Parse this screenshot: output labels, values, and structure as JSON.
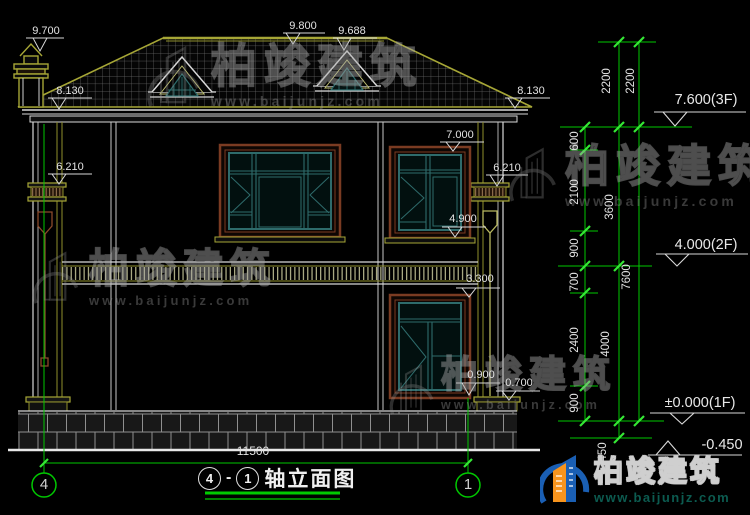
{
  "drawing": {
    "title": {
      "axis_left": "4",
      "dash": "-",
      "axis_right": "1",
      "name": "轴立面图"
    },
    "total_width_dim": "11500",
    "axis_bubbles": {
      "left": "4",
      "right": "1"
    },
    "elevations": {
      "chimney_top": "9.700",
      "ridge": "9.800",
      "dormer_top": "9.688",
      "eave_left": "8.130",
      "eave_right": "8.130",
      "capital_left": "6.210",
      "capital_right": "6.210",
      "win2f_head": "7.000",
      "win2f_sill": "4.900",
      "win1f_head": "3.300",
      "win1f_sill": "0.900",
      "pedestal_top": "0.700"
    },
    "levels": {
      "f3": "7.600(3F)",
      "f2": "4.000(2F)",
      "f1": "±0.000(1F)",
      "ground": "-0.450"
    },
    "dims": {
      "detail": [
        "600",
        "2100",
        "900",
        "700",
        "2400",
        "900"
      ],
      "floors": [
        "2200",
        "3600",
        "4000",
        "450"
      ],
      "totals": [
        "2200",
        "7600"
      ]
    }
  },
  "watermark": {
    "brand": "柏竣建筑",
    "url": "www.baijunjz.com"
  },
  "logo": {
    "brand": "柏竣建筑",
    "url": "www.baijunjz.com"
  },
  "colors": {
    "dim_green": "#00d400",
    "line_white": "#dcdcdc",
    "trim_olive": "#a6a636",
    "window_teal": "#2e6b6b",
    "frame_brown": "#7a3b22",
    "logo_blue": "#1a5fb4",
    "logo_orange": "#f7941d"
  }
}
